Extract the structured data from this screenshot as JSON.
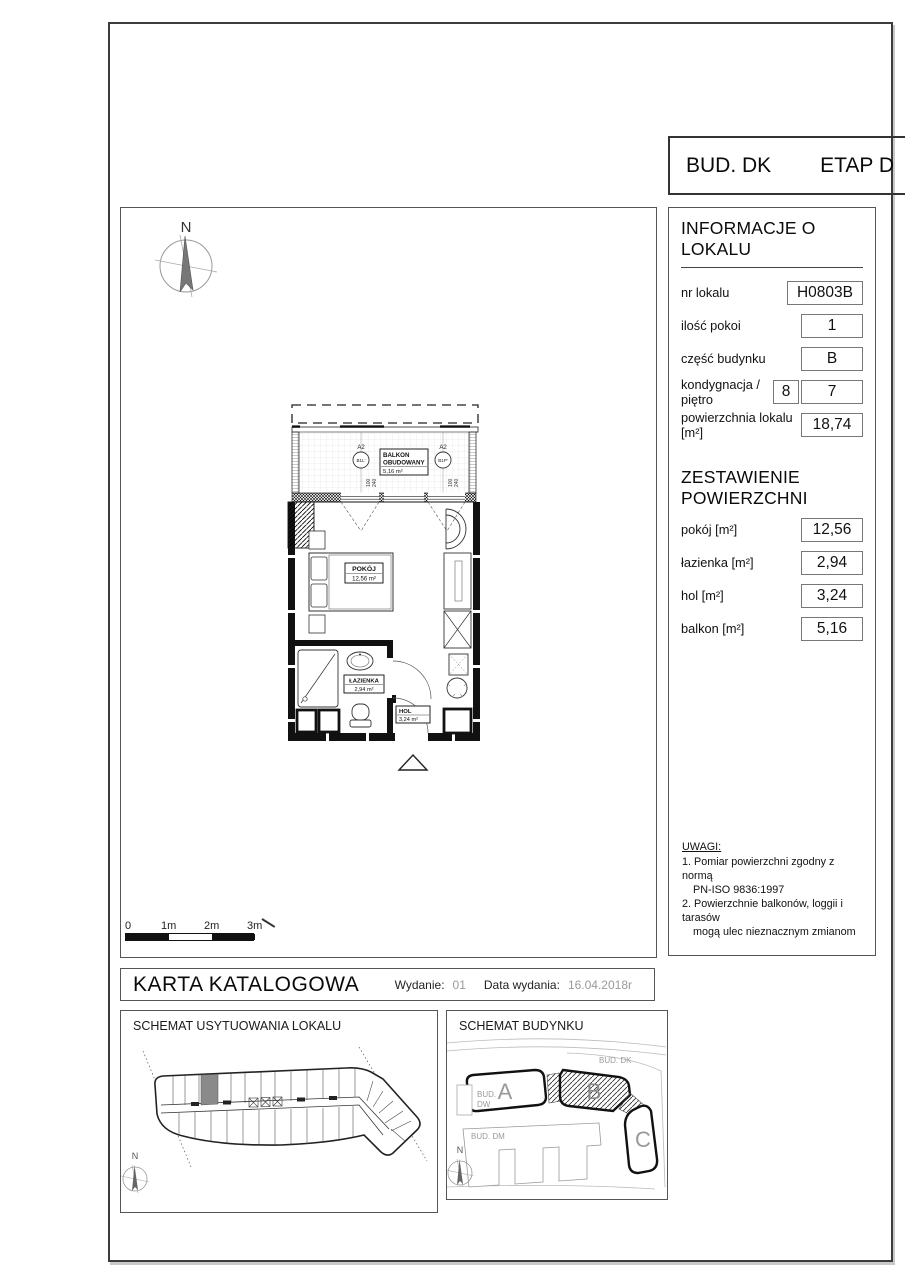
{
  "header": {
    "building": "BUD. DK",
    "stage": "ETAP D"
  },
  "info_panel": {
    "title": "INFORMACJE O LOKALU",
    "fields": [
      {
        "label": "nr lokalu",
        "value": "H0803B"
      },
      {
        "label": "ilość pokoi",
        "value": "1"
      },
      {
        "label": "część budynku",
        "value": "B"
      },
      {
        "label": "kondygnacja / piętro",
        "value2": "8",
        "value": "7"
      },
      {
        "label": "powierzchnia lokalu [m²]",
        "value": "18,74"
      }
    ]
  },
  "areas_panel": {
    "title": "ZESTAWIENIE POWIERZCHNI",
    "fields": [
      {
        "label": "pokój [m²]",
        "value": "12,56"
      },
      {
        "label": "łazienka [m²]",
        "value": "2,94"
      },
      {
        "label": "hol [m²]",
        "value": "3,24"
      },
      {
        "label": "balkon [m²]",
        "value": "5,16"
      }
    ]
  },
  "notes": {
    "title": "UWAGI:",
    "items": [
      [
        "1. Pomiar powierzchni zgodny z normą",
        "PN-ISO 9836:1997"
      ],
      [
        "2. Powierzchnie balkonów, loggii i tarasów",
        "mogą ulec nieznacznym zmianom"
      ]
    ]
  },
  "footer": {
    "title": "KARTA KATALOGOWA",
    "edition_label": "Wydanie:",
    "edition": "01",
    "date_label": "Data wydania:",
    "date": "16.04.2018r"
  },
  "plan": {
    "north": "N",
    "balcony": {
      "line1": "BALKON",
      "line2": "OBUDOWANY",
      "area": "5,16 m²"
    },
    "windows": [
      {
        "code": "A2",
        "id": "B1L'",
        "dim1": "100",
        "dim2": "240"
      },
      {
        "code": "A2",
        "id": "B1P'",
        "dim1": "100",
        "dim2": "240"
      }
    ],
    "rooms": {
      "pokoj": {
        "name": "POKÓJ",
        "area": "12,56 m²"
      },
      "lazienka": {
        "name": "ŁAZIENKA",
        "area": "2,94 m²"
      },
      "hol": {
        "name": "HOL",
        "area": "3,24 m²"
      }
    },
    "scale_labels": [
      "0",
      "1m",
      "2m",
      "3m"
    ]
  },
  "schemat_lokalu": {
    "title": "SCHEMAT USYTUOWANIA LOKALU",
    "north": "N"
  },
  "schemat_budynku": {
    "title": "SCHEMAT BUDYNKU",
    "north": "N",
    "labels": {
      "bud_dk": "BUD. DK",
      "bud_dw_1": "BUD.",
      "bud_dw_2": "DW",
      "bud_dm": "BUD. DM",
      "a": "A",
      "b": "B",
      "c": "C"
    }
  },
  "colors": {
    "accent": "#111111",
    "muted": "#9a9a9a",
    "highlight_unit": "#8a8a8a"
  }
}
